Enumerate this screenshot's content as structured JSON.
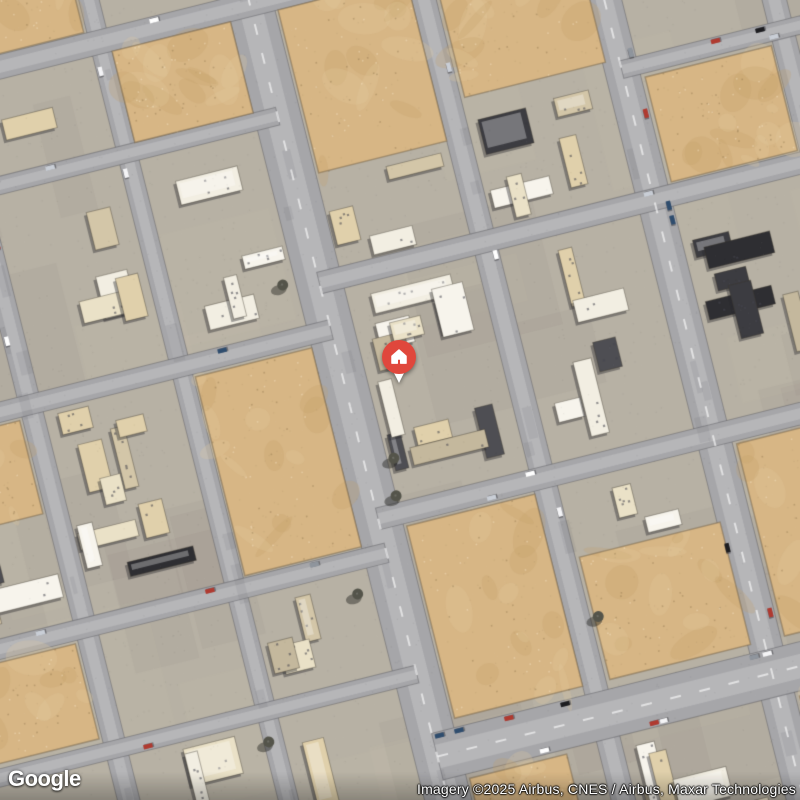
{
  "branding": {
    "logo_text": "Google"
  },
  "attribution": {
    "text": "Imagery ©2025 Airbus, CNES / Airbus, Maxar Technologies"
  },
  "marker": {
    "type": "home-place-marker",
    "color": "#E0473C",
    "screen_x": 399,
    "screen_y": 357
  },
  "map": {
    "rotation_deg": -14,
    "seed": 7,
    "palette": {
      "block_base": "#b7b1a4",
      "road": "#a6a6a9",
      "road_light": "#c6c5c8",
      "sand": "#d7b685",
      "sand_light": "#e3cb9f",
      "sand_dark": "#c29e69",
      "building_colors": [
        "#f2eee2",
        "#eae1c7",
        "#e0d0ab",
        "#d3c6a8",
        "#c4b89d",
        "#f7f4ec"
      ],
      "dark_roofs": [
        "#2e2e32",
        "#3c3c41",
        "#4e4e53"
      ],
      "tree": "#54544a",
      "car_colors": [
        "#ffffff",
        "#f4f4f6",
        "#1d1d20",
        "#8f959d",
        "#c9ced6",
        "#b03a30",
        "#2f4d6e"
      ]
    },
    "roads": {
      "vertical": [
        {
          "x": -540,
          "w": 20
        },
        {
          "x": -360,
          "w": 22
        },
        {
          "x": -205,
          "w": 20
        },
        {
          "x": -50,
          "w": 46,
          "main": true
        },
        {
          "x": 120,
          "w": 24
        },
        {
          "x": 295,
          "w": 34,
          "main": true
        },
        {
          "x": 460,
          "w": 24
        },
        {
          "x": 625,
          "w": 22
        }
      ],
      "horizontal": [
        {
          "y": -420,
          "w": 24,
          "x0": -780,
          "x1": 780
        },
        {
          "y": -305,
          "w": 18,
          "x0": -780,
          "x1": -50
        },
        {
          "y": -85,
          "w": 20,
          "x0": -780,
          "x1": -50
        },
        {
          "y": 145,
          "w": 20,
          "x0": -780,
          "x1": -50
        },
        {
          "y": 270,
          "w": 18,
          "x0": -780,
          "x1": -50
        },
        {
          "y": 490,
          "w": 22,
          "x0": -780,
          "x1": -50
        },
        {
          "y": -267,
          "w": 18,
          "x0": 295,
          "x1": 780
        },
        {
          "y": -133,
          "w": 22,
          "x0": -50,
          "x1": 780
        },
        {
          "y": 110,
          "w": 22,
          "x0": -50,
          "x1": 780
        },
        {
          "y": 355,
          "w": 48,
          "x0": -50,
          "x1": 780,
          "main": true
        },
        {
          "y": 560,
          "w": 20,
          "x0": -50,
          "x1": 780
        }
      ]
    },
    "sand_lots": [
      {
        "x": -195,
        "y": -408,
        "w": 122,
        "h": 94
      },
      {
        "x": -24,
        "y": -408,
        "w": 132,
        "h": 168
      },
      {
        "x": 136,
        "y": -408,
        "w": 145,
        "h": 130
      },
      {
        "x": -193,
        "y": -72,
        "w": 120,
        "h": 205
      },
      {
        "x": -24,
        "y": 124,
        "w": 132,
        "h": 198
      },
      {
        "x": 136,
        "y": 196,
        "w": 145,
        "h": 126
      },
      {
        "x": 316,
        "y": 124,
        "w": 130,
        "h": 198
      },
      {
        "x": 316,
        "y": -254,
        "w": 130,
        "h": 108
      },
      {
        "x": -528,
        "y": -72,
        "w": 154,
        "h": 96
      },
      {
        "x": -528,
        "y": 158,
        "w": 154,
        "h": 98
      },
      {
        "x": -348,
        "y": -555,
        "w": 130,
        "h": 122
      },
      {
        "x": 316,
        "y": 384,
        "w": 130,
        "h": 140
      },
      {
        "x": -24,
        "y": 384,
        "w": 100,
        "h": 120
      }
    ],
    "dark_zones": [
      {
        "x": 196,
        "y": -30,
        "w": 115,
        "h": 200
      },
      {
        "x": 315,
        "y": -125,
        "w": 130,
        "h": 230
      },
      {
        "x": -268,
        "y": -340,
        "w": 120,
        "h": 140
      },
      {
        "x": -30,
        "y": 48,
        "w": 150,
        "h": 62
      },
      {
        "x": -400,
        "y": 80,
        "w": 130,
        "h": 120
      }
    ],
    "trees": [
      {
        "x": -86,
        "y": -140
      },
      {
        "x": -20,
        "y": 55
      },
      {
        "x": -27,
        "y": 92
      },
      {
        "x": -88,
        "y": 178
      },
      {
        "x": 140,
        "y": 258
      },
      {
        "x": -210,
        "y": 300
      }
    ]
  }
}
